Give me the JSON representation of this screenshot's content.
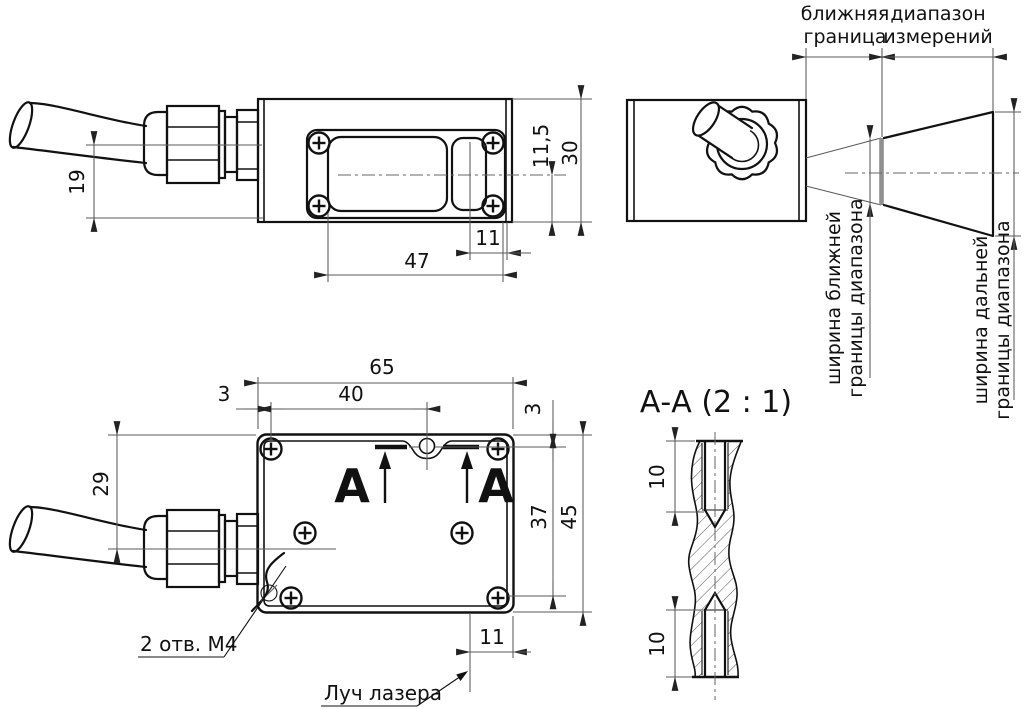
{
  "drawing": {
    "kind": "laser-sensor-outline-drawing",
    "line_color": "#111111",
    "dim_color": "#5a5a5a",
    "background": "#ffffff"
  },
  "side_view": {
    "dim_cable_axis_to_bottom": "19",
    "dim_axis_to_bottom": "11,5",
    "dim_height": "30",
    "dim_window_to_edge": "11",
    "dim_window_width": "47"
  },
  "front_view": {
    "near_boundary_label_line1": "ближняя",
    "near_boundary_label_line2": "граница",
    "range_label_line1": "диапазон",
    "range_label_line2": "измерений",
    "near_width_label_line1": "ширина ближней",
    "near_width_label_line2": "границы диапазона",
    "far_width_label_line1": "ширина дальней",
    "far_width_label_line2": "границы диапазона"
  },
  "top_view": {
    "dim_length": "65",
    "dim_edge_to_screw": "3",
    "dim_screw_to_hole": "40",
    "dim_top_to_cable_axis": "29",
    "dim_edge_to_section": "3",
    "dim_screw_rows": "37",
    "dim_width": "45",
    "dim_beam_to_edge": "11",
    "section_letter_left": "А",
    "section_letter_right": "А",
    "note_mounting_holes": "2 отв. М4",
    "note_laser_beam": "Луч лазера"
  },
  "section_view": {
    "title": "А-А (2 : 1)",
    "dim_thread_depth_top": "10",
    "dim_thread_depth_bottom": "10"
  }
}
